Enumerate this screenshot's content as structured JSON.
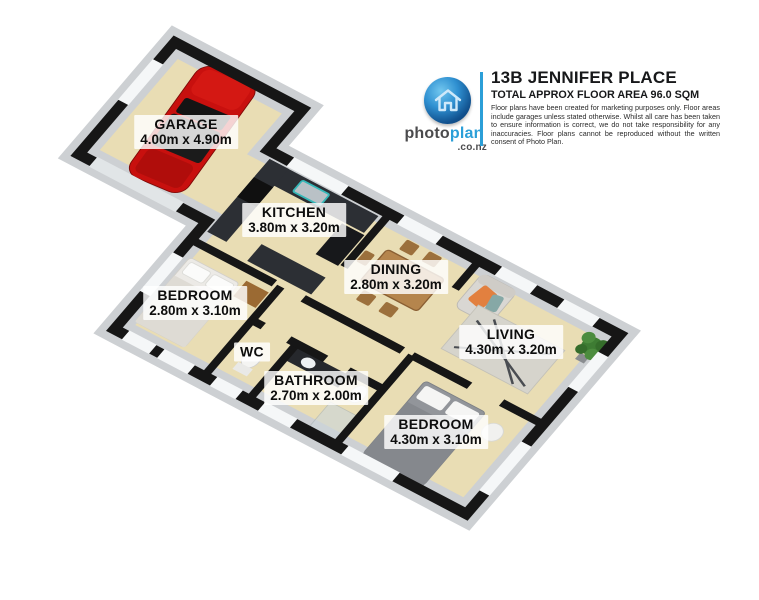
{
  "header": {
    "title": "13B JENNIFER PLACE",
    "subtitle": "TOTAL APPROX FLOOR AREA 96.0 SQM",
    "disclaimer": "Floor plans have been created for marketing purposes only. Floor areas include garages unless stated otherwise. Whilst all care has been taken to ensure information is correct, we do not take responsibility for any inaccuracies. Floor plans cannot be reproduced without the written consent of Photo Plan.",
    "brand": {
      "photo": "photo",
      "plan": "plan",
      "suffix": ".co.nz",
      "icon": "house-icon",
      "accent_color": "#2b9fd8"
    }
  },
  "floorplan": {
    "rooms": [
      {
        "id": "garage",
        "name": "GARAGE",
        "dimensions": "4.00m x 4.90m"
      },
      {
        "id": "kitchen",
        "name": "KITCHEN",
        "dimensions": "3.80m x 3.20m"
      },
      {
        "id": "bedroom-1",
        "name": "BEDROOM",
        "dimensions": "2.80m x 3.10m"
      },
      {
        "id": "wc",
        "name": "WC",
        "dimensions": ""
      },
      {
        "id": "dining",
        "name": "DINING",
        "dimensions": "2.80m x 3.20m"
      },
      {
        "id": "bathroom",
        "name": "BATHROOM",
        "dimensions": "2.70m x 2.00m"
      },
      {
        "id": "living",
        "name": "LIVING",
        "dimensions": "4.30m x 3.20m"
      },
      {
        "id": "bedroom-2",
        "name": "BEDROOM",
        "dimensions": "4.30m x 3.10m"
      }
    ],
    "colors": {
      "floor": "#e9ddb4",
      "walls": "#161616",
      "wall_band": "#cdd0d3",
      "car": "#c8100e"
    }
  }
}
